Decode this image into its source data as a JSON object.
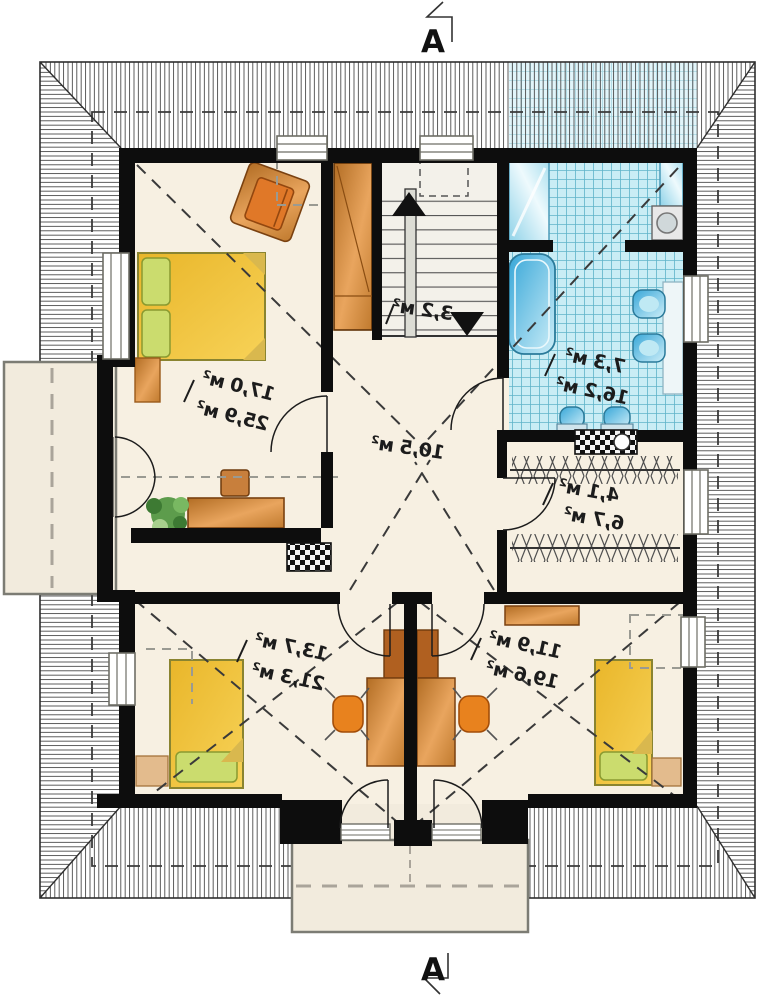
{
  "section_markers": {
    "top_label": "A",
    "bottom_label": "A"
  },
  "area_labels": {
    "bedroom_top_left": {
      "line1": "17,0 м²",
      "line2": "25,9 м²"
    },
    "staircase": {
      "line1": "3,2 м²"
    },
    "hall": {
      "line1": "10,5 м²"
    },
    "bathroom": {
      "line1": "7,3 м²",
      "line2": "16,2 м²"
    },
    "wardrobe": {
      "line1": "4,1 м²",
      "line2": "6,7 м²"
    },
    "bedroom_bottom_left": {
      "line1": "13,7 м²",
      "line2": "21,3 м²"
    },
    "bedroom_bottom_right": {
      "line1": "11,9 м²",
      "line2": "19,6 м²"
    }
  },
  "colors": {
    "floor": "#f7f0e2",
    "wall": "#0d0d0d",
    "bathroom_tile": "#c9edf5",
    "wood": "#cd8740",
    "bed_yellow": "#f3c337",
    "pillow_green": "#cbdc6e",
    "fixture_blue": "#4ab4dc",
    "chair_orange": "#e8821e",
    "plant_green": "#5d9c4c",
    "roof_hatch": "#4a4a4a",
    "balcony_slab": "#f2ebdd"
  }
}
